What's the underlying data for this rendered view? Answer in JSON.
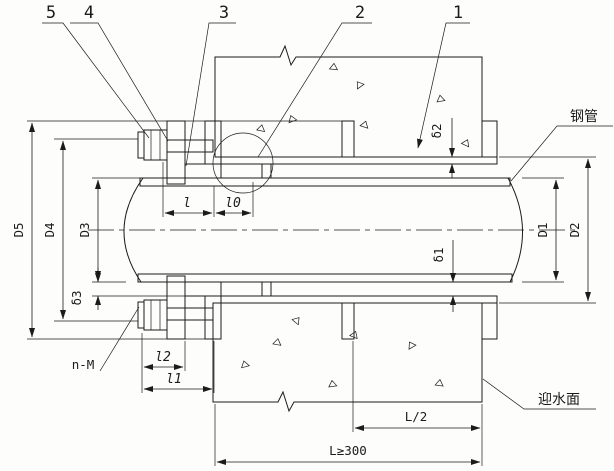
{
  "callouts": {
    "c5": "5",
    "c4": "4",
    "c3": "3",
    "c2": "2",
    "c1": "1"
  },
  "labels": {
    "steel_pipe": "钢管",
    "water_facing_surface": "迎水面",
    "bolt_count_size": "n-M"
  },
  "dims": {
    "D5": "D5",
    "D4": "D4",
    "D3": "D3",
    "delta3": "δ3",
    "delta2": "δ2",
    "delta1": "δ1",
    "D1": "D1",
    "D2": "D2",
    "l": "l",
    "l0": "l0",
    "l2": "l2",
    "l1": "l1",
    "half_wall": "L/2",
    "wall_min": "L≥300"
  }
}
